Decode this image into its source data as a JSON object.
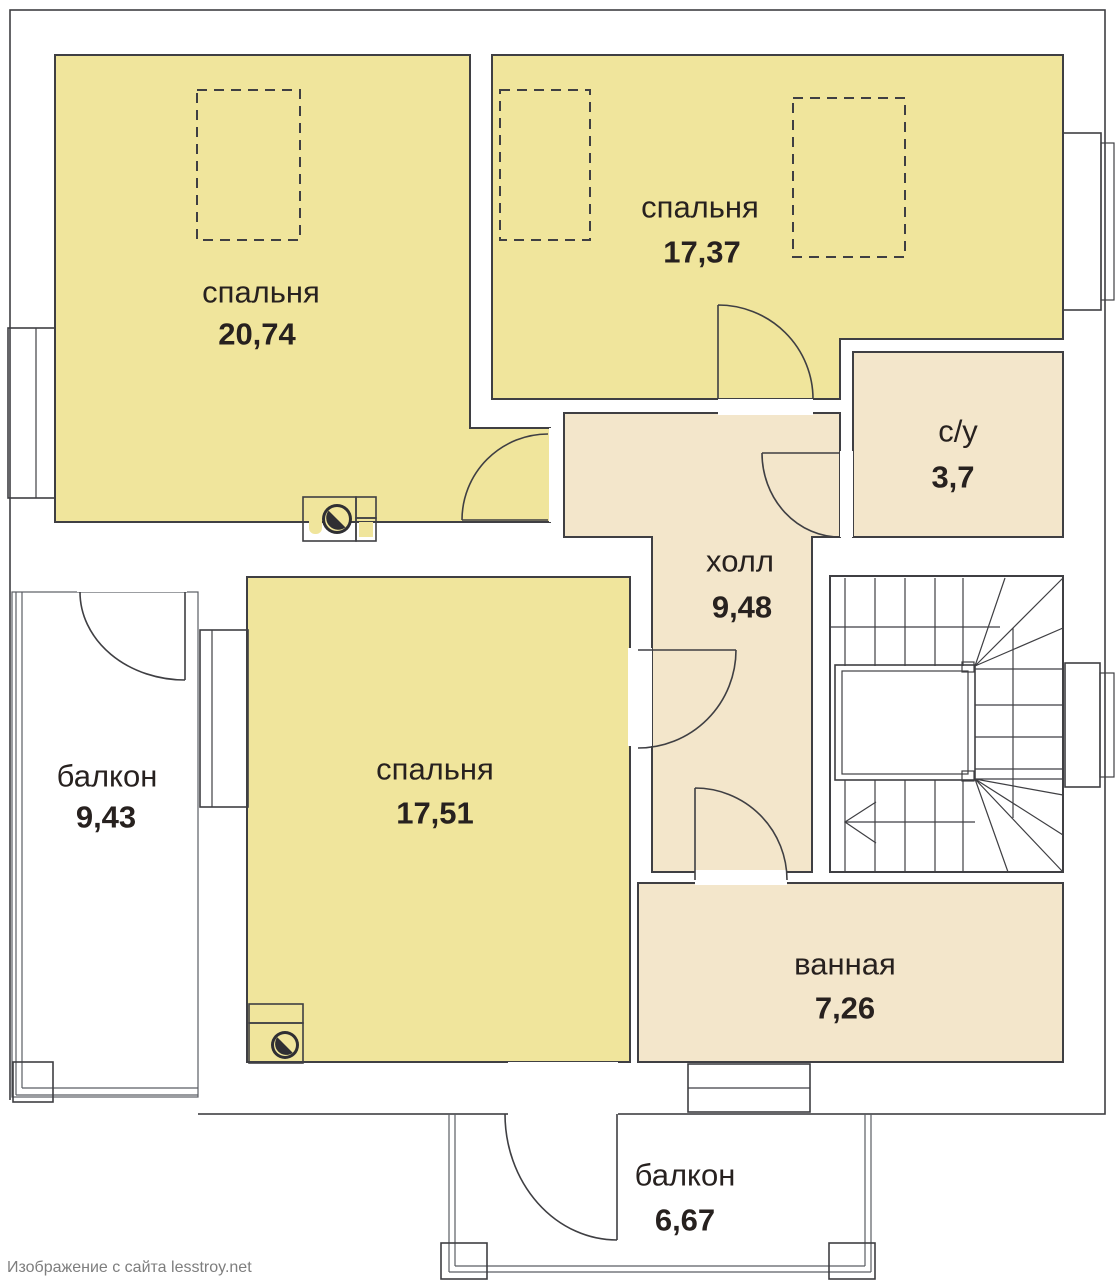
{
  "rooms": {
    "bedroom_top_left": {
      "name": "спальня",
      "area": "20,74"
    },
    "bedroom_top_right": {
      "name": "спальня",
      "area": "17,37"
    },
    "bedroom_middle": {
      "name": "спальня",
      "area": "17,51"
    },
    "hall": {
      "name": "холл",
      "area": "9,48"
    },
    "wc": {
      "name": "с/у",
      "area": "3,7"
    },
    "bathroom": {
      "name": "ванная",
      "area": "7,26"
    },
    "balcony_left": {
      "name": "балкон",
      "area": "9,43"
    },
    "balcony_bottom": {
      "name": "балкон",
      "area": "6,67"
    }
  },
  "watermark": "Изображение с сайта lesstroy.net",
  "colors": {
    "wall": "#8b8f97",
    "bedroom_fill": "#f0e59c",
    "utility_fill": "#f3e6cb",
    "outline": "#3f3f43",
    "label_text": "#27211f",
    "watermark_text": "#7e7e7e"
  }
}
